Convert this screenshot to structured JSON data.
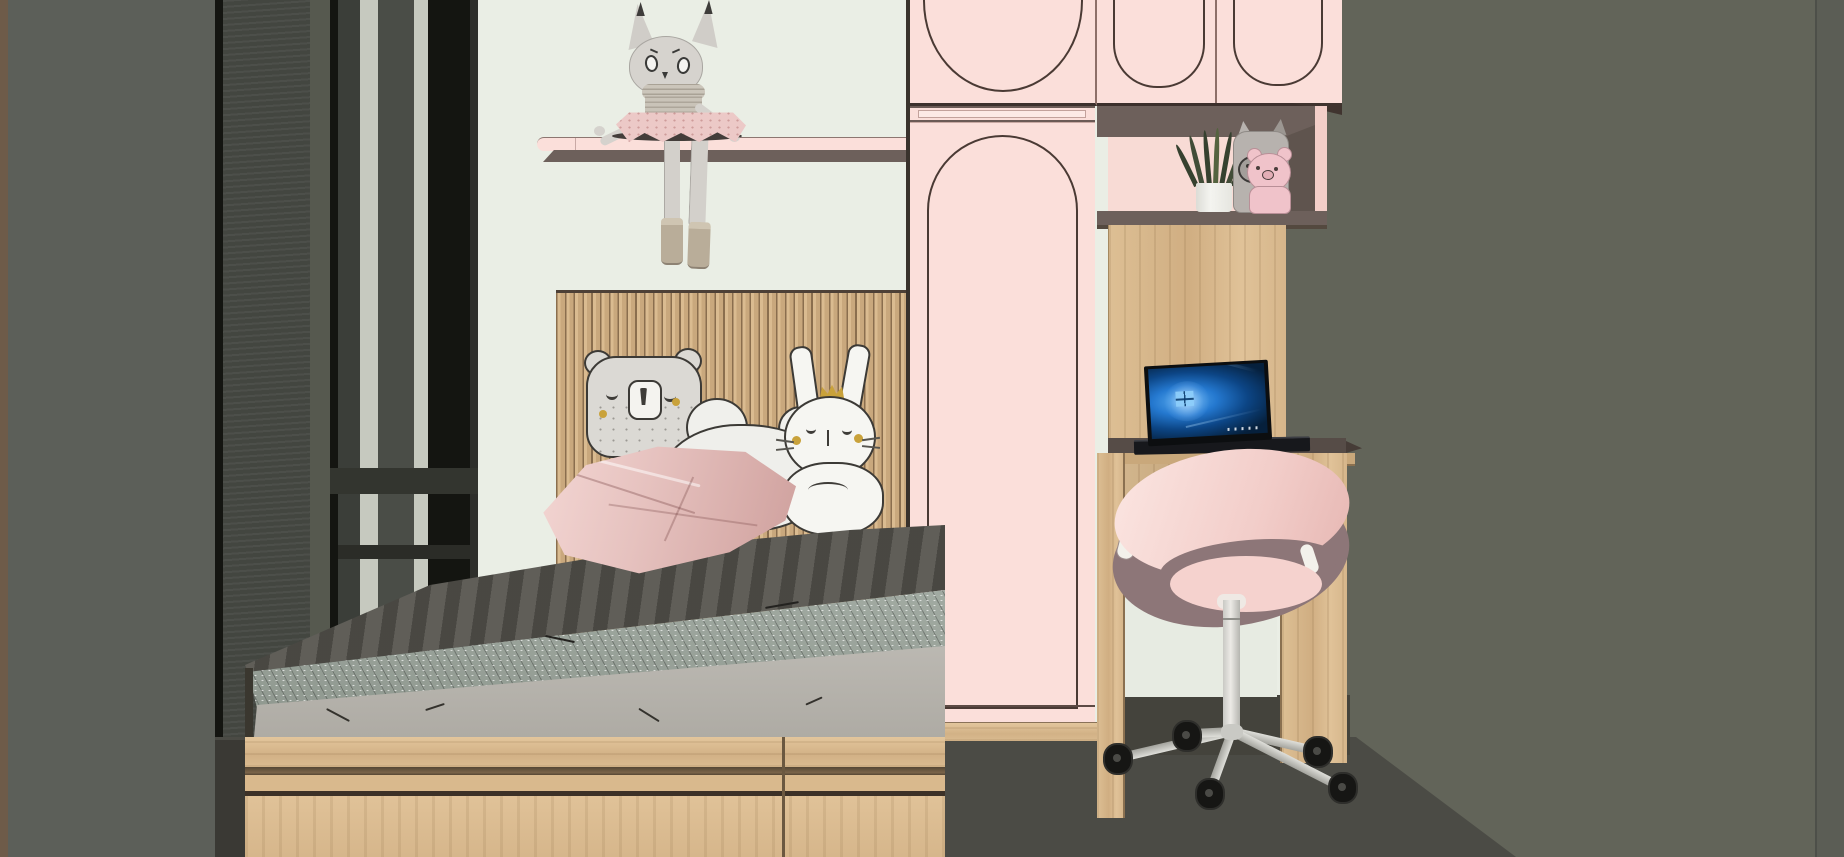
{
  "scene": {
    "type": "3d-interior-render",
    "room": "children's bedroom with platform bed, pink wardrobe, desk nook and swivel chair",
    "style": "flat-shaded architectural visualization, pastel pink / light oak / charcoal palette",
    "visible_text": ""
  },
  "palette": {
    "edge_brown": "#6e5b49",
    "wall_left": "#5c5f59",
    "wall_right": "#626459",
    "wall_mint": "#eaeee5",
    "curtain_dark": "#434640",
    "curtain_mid": "#56594f",
    "frame_black": "#141511",
    "sliver_light": "#c6c9bf",
    "shade_mid": "#4a4d47",
    "pink_panel": "#fbdfda",
    "pink_deep": "#f3cfc9",
    "line_dark": "#4a3a34",
    "taupe_frame": "#6d605b",
    "wood": "#dabb90",
    "wood_line": "#584732",
    "floor": "#4b4b45",
    "floor_dark": "#3a3934",
    "duvet": "#57554f",
    "duvet_band": "#9aa39c",
    "mattress": "#b6b3ac",
    "pillow_pink": "#e8c7c4",
    "plush_gray": "#d8d5d0",
    "plush_outline": "#3c3a36",
    "chair_pink": "#f8dad6",
    "chair_rim": "#8d7678",
    "chair_metal": "#d4d4cf",
    "leaf_green": "#36412f",
    "gold": "#c9a23b",
    "toy_gray": "#b7b2ae",
    "toy_pink": "#f0c3ca"
  },
  "objects": {
    "plush_doll": "gray cat rag-doll with pink tutu sitting on wall shelf, legs dangling",
    "wall_shelf": "blush pink floating shelf with dark underside",
    "wardrobe": "tall blush wardrobe with arched door molding and oak plinth",
    "overhead_cabinets": "pink overhead cabinets with arched moldings",
    "display_niche": "taupe-framed niche holding a snake plant and two animal figurines",
    "desk": "built-in light oak desk below the niche",
    "laptop": "open laptop with glowing blue wallpaper",
    "chair": "pink shell swivel chair on five-star caster base",
    "bed": "light oak platform bed with gray fitted mattress and charcoal duvet",
    "headboard": "vertical oak slat headboard panel",
    "pillow_bear": "gray bear face cushion",
    "pillow_heart": "white quilted heart cushion",
    "pillow_bunny": "white bunny cushion with tiny gold crown",
    "pillow_pink": "pink satin throw pillow",
    "window": "dark-framed window with charcoal curtain panels",
    "floor": "dark warm-gray floor"
  }
}
